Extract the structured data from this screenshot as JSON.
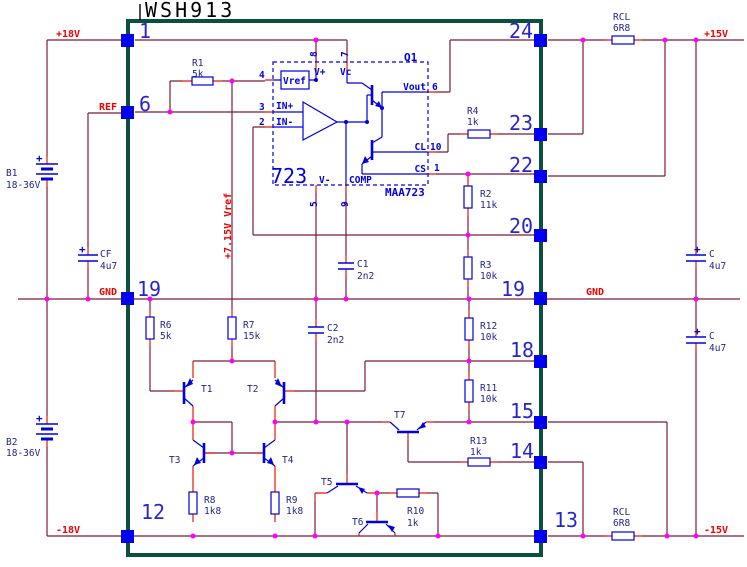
{
  "title": "WSH913",
  "colors": {
    "wire": "#7a1d38",
    "stub": "#ee1500",
    "sym": "#0000e0",
    "pinsq": "#0000f0",
    "dot": "#ff00ff",
    "netlbl": "#ee0000",
    "complbl": "#23238c",
    "box": "#0b4f3e",
    "numlbl": "#2626cc",
    "titlecol": "#000000"
  },
  "nets": {
    "plus18": "+18V",
    "ref": "REF",
    "gnd_left": "GND",
    "minus18": "-18V",
    "gnd_right": "GND",
    "plus15": "+15V",
    "minus15": "-15V",
    "vref_rail": "+7.15V Vref"
  },
  "pins": {
    "p1": "1",
    "p6": "6",
    "p19_left": "19",
    "p12": "12",
    "p24": "24",
    "p23": "23",
    "p22": "22",
    "p20": "20",
    "p19_right": "19",
    "p18": "18",
    "p15": "15",
    "p14": "14",
    "p13": "13"
  },
  "ic": {
    "designator": "Q1",
    "label": "723",
    "part": "MAA723",
    "pin_names": {
      "vref": "Vref",
      "vplus": "V+",
      "vc": "Vc",
      "vout": "Vout",
      "cl": "CL",
      "cs": "CS",
      "comp": "COMP",
      "vminus": "V-",
      "in_plus": "IN+",
      "in_minus": "IN-"
    },
    "pin_numbers": {
      "n8": "8",
      "n7": "7",
      "n4": "4",
      "n3": "3",
      "n2": "2",
      "n6": "6",
      "n10": "10",
      "n1": "1",
      "n5": "5",
      "n9": "9"
    }
  },
  "components": {
    "R1": {
      "name": "R1",
      "value": "5k"
    },
    "R2": {
      "name": "R2",
      "value": "11k"
    },
    "R3": {
      "name": "R3",
      "value": "10k"
    },
    "R4": {
      "name": "R4",
      "value": "1k"
    },
    "R6": {
      "name": "R6",
      "value": "5k"
    },
    "R7": {
      "name": "R7",
      "value": "15k"
    },
    "R8": {
      "name": "R8",
      "value": "1k8"
    },
    "R9": {
      "name": "R9",
      "value": "1k8"
    },
    "R10": {
      "name": "R10",
      "value": "1k"
    },
    "R11": {
      "name": "R11",
      "value": "10k"
    },
    "R12": {
      "name": "R12",
      "value": "10k"
    },
    "R13": {
      "name": "R13",
      "value": "1k"
    },
    "RCL_top": {
      "name": "RCL",
      "value": "6R8"
    },
    "RCL_bottom": {
      "name": "RCL",
      "value": "6R8"
    },
    "C1": {
      "name": "C1",
      "value": "2n2"
    },
    "C2": {
      "name": "C2",
      "value": "2n2"
    },
    "CF": {
      "name": "CF",
      "value": "4u7"
    },
    "C_right_top": {
      "name": "C",
      "value": "4u7"
    },
    "C_right_bottom": {
      "name": "C",
      "value": "4u7"
    },
    "B1": {
      "name": "B1",
      "value": "18-36V"
    },
    "B2": {
      "name": "B2",
      "value": "18-36V"
    },
    "T1": {
      "name": "T1"
    },
    "T2": {
      "name": "T2"
    },
    "T3": {
      "name": "T3"
    },
    "T4": {
      "name": "T4"
    },
    "T5": {
      "name": "T5"
    },
    "T6": {
      "name": "T6"
    },
    "T7": {
      "name": "T7"
    }
  },
  "polarity_mark": "+"
}
